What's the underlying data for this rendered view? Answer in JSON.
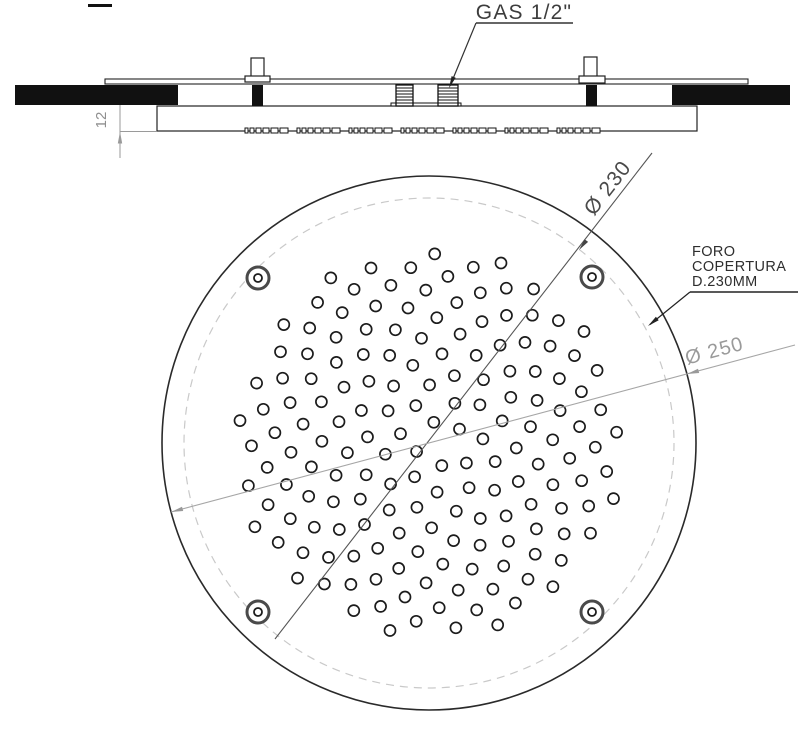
{
  "labels": {
    "gas": "GAS 1/2\"",
    "protrusion": "12",
    "cutout_dia": "Ø 230",
    "plate_dia": "Ø 250",
    "foro": [
      "FORO",
      "COPERTURA",
      "D.230MM"
    ]
  },
  "colors": {
    "ink": "#222222",
    "fill_black": "#111111",
    "dim_dark": "#555555",
    "dim_light": "#a6a6a6",
    "dashed_circle": "#c9c9c9",
    "text_gray": "#8f8f8f",
    "hole_stroke": "#1c1c1c",
    "screw_ring": "#4a4a4a"
  },
  "section": {
    "dash_mark": [
      88,
      4,
      24,
      3
    ],
    "plate": [
      105,
      79,
      643,
      5
    ],
    "left_bar": [
      15,
      85,
      163,
      20
    ],
    "right_bar": [
      672,
      85,
      118,
      20
    ],
    "body": [
      157,
      106,
      540,
      25
    ],
    "studs": [
      {
        "shaft": [
          251,
          58,
          13,
          20
        ],
        "flange": [
          245,
          76,
          25,
          6
        ],
        "pin": [
          252,
          85,
          11,
          21
        ]
      },
      {
        "shaft": [
          584,
          57,
          13,
          21
        ],
        "flange": [
          579,
          76,
          26,
          7
        ],
        "pin": [
          586,
          85,
          11,
          21
        ]
      }
    ],
    "threads": [
      [
        396,
        85,
        17,
        21
      ],
      [
        438,
        85,
        20,
        21
      ]
    ],
    "thread_base": [
      391,
      103,
      70,
      3
    ],
    "strip": {
      "x0": 245,
      "x1": 601,
      "y": 128,
      "h": 5
    },
    "hatch_step": 3
  },
  "plan": {
    "cx": 429,
    "cy": 443,
    "r_outer": 267,
    "r_dashed": 245,
    "screws": [
      [
        258,
        278
      ],
      [
        592,
        277
      ],
      [
        258,
        612
      ],
      [
        592,
        612
      ]
    ],
    "screw_outer_r": 11,
    "screw_inner_r": 4,
    "nozzles": {
      "type": "phyllotaxis",
      "count": 168,
      "scale": 15,
      "hole_r": 5.5,
      "golden_deg": 137.50776,
      "rot_deg": 8
    }
  }
}
